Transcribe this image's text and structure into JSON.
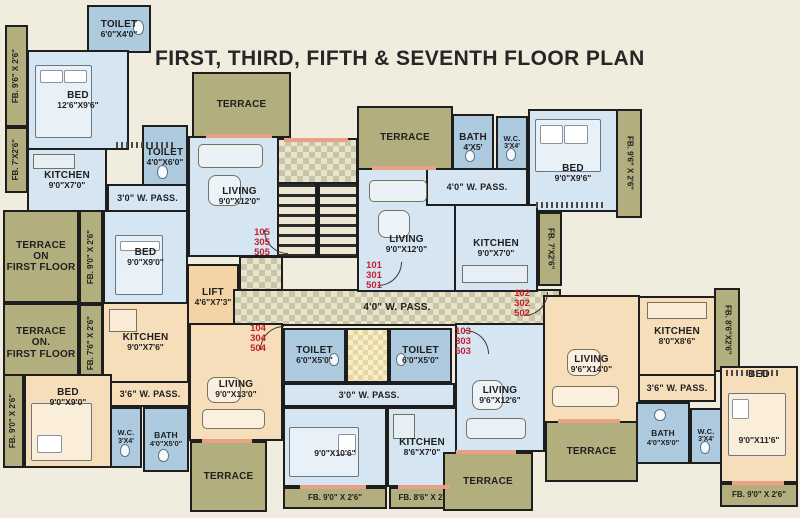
{
  "title": "FIRST, THIRD, FIFTH & SEVENTH FLOOR PLAN",
  "units": {
    "u105": "105\n305\n505",
    "u101": "101\n301\n501",
    "u102": "102\n302\n502",
    "u104": "104\n304\n504",
    "u103": "103\n303\n503"
  },
  "rooms": {
    "toilet_top": {
      "name": "TOILET",
      "dims": "6'0\"X4'0\""
    },
    "bed_105a": {
      "name": "BED",
      "dims": "12'6\"X9'6\""
    },
    "kitchen_105": {
      "name": "KITCHEN",
      "dims": "9'0\"X7'0\""
    },
    "toilet_105": {
      "name": "TOILET",
      "dims": "4'0\"X6'0\""
    },
    "pass_105": {
      "name": "3'0\" W. PASS."
    },
    "terrace_105": {
      "name": "TERRACE"
    },
    "living_105": {
      "name": "LIVING",
      "dims": "9'0\"X12'0\""
    },
    "bed_105b": {
      "name": "BED",
      "dims": "9'0\"X9'0\""
    },
    "terr_f1": {
      "name": "TERRACE\nON\nFIRST FLOOR"
    },
    "terr_f2": {
      "name": "TERRACE\nON.\nFIRST FLOOR"
    },
    "lift": {
      "name": "LIFT",
      "dims": "4'6\"X7'3\""
    },
    "corridor": {
      "name": "4'0\" W. PASS."
    },
    "terrace_101": {
      "name": "TERRACE"
    },
    "bath_101": {
      "name": "BATH",
      "dims": "4'X5'"
    },
    "wc_101": {
      "name": "W.C.",
      "dims": "3'X4'"
    },
    "bed_101": {
      "name": "BED",
      "dims": "9'0\"X9'6\""
    },
    "pass_101": {
      "name": "4'0\" W. PASS."
    },
    "living_101": {
      "name": "LIVING",
      "dims": "9'0\"X12'0\""
    },
    "kitchen_101": {
      "name": "KITCHEN",
      "dims": "9'0\"X7'0\""
    },
    "living_102": {
      "name": "LIVING",
      "dims": "9'6\"X14'0\""
    },
    "kitchen_102": {
      "name": "KITCHEN",
      "dims": "8'0\"X8'6\""
    },
    "pass_102": {
      "name": "3'6\" W. PASS."
    },
    "bath_102": {
      "name": "BATH",
      "dims": "4'0\"X5'0\""
    },
    "wc_102": {
      "name": "W.C.",
      "dims": "3'X4'"
    },
    "bed_102": {
      "name": "BED",
      "dims": "9'0\"X11'6\""
    },
    "terrace_102": {
      "name": "TERRACE"
    },
    "kitchen_104": {
      "name": "KITCHEN",
      "dims": "9'0\"X7'6\""
    },
    "living_104": {
      "name": "LIVING",
      "dims": "9'0\"X13'0\""
    },
    "bed_104": {
      "name": "BED",
      "dims": "9'0\"X9'0\""
    },
    "pass_104": {
      "name": "3'6\" W. PASS."
    },
    "wc_104": {
      "name": "W.C.",
      "dims": "3'X4'"
    },
    "bath_104": {
      "name": "BATH",
      "dims": "4'0\"X5'0\""
    },
    "terrace_104": {
      "name": "TERRACE"
    },
    "toilet_104": {
      "name": "TOILET",
      "dims": "6'0\"X5'0\""
    },
    "toilet_103": {
      "name": "TOILET",
      "dims": "6'0\"X5'0\""
    },
    "living_103": {
      "name": "LIVING",
      "dims": "9'6\"X12'6\""
    },
    "pass_103": {
      "name": "3'0\" W. PASS."
    },
    "bed_103": {
      "name": "BED",
      "dims": "9'0\"X10'6\""
    },
    "kitchen_103": {
      "name": "KITCHEN",
      "dims": "8'6\"X7'0\""
    },
    "terrace_103": {
      "name": "TERRACE"
    }
  },
  "fb": {
    "l1": "FB. 9'6\" X 2'6\"",
    "l2": "FB. 7'X2'6\"",
    "l3": "FB. 9'0\" X 2'6\"",
    "l4": "FB. 7'6\" X 2'6\"",
    "l5": "FB. 9'0\" X 2'6\"",
    "b1": "FB. 9'0\" X 2'6\"",
    "b2": "FB. 8'6\" X 2'6\"",
    "b3": "FB. 9'0\" X 2'6\"",
    "r1": "FB. 9'6\" X 2'6\"",
    "r2": "FB. 7'X2'6\"",
    "r3": "FB. 8'6\"X2'6\""
  },
  "colors": {
    "background": "#f1edde",
    "room_blue": "#d5e5f1",
    "bath_blue": "#aecadf",
    "peach": "#f6debb",
    "terrace_olive": "#b2ae7e",
    "wall": "#1e1e1e",
    "unit_number_red": "#c41f2f"
  }
}
